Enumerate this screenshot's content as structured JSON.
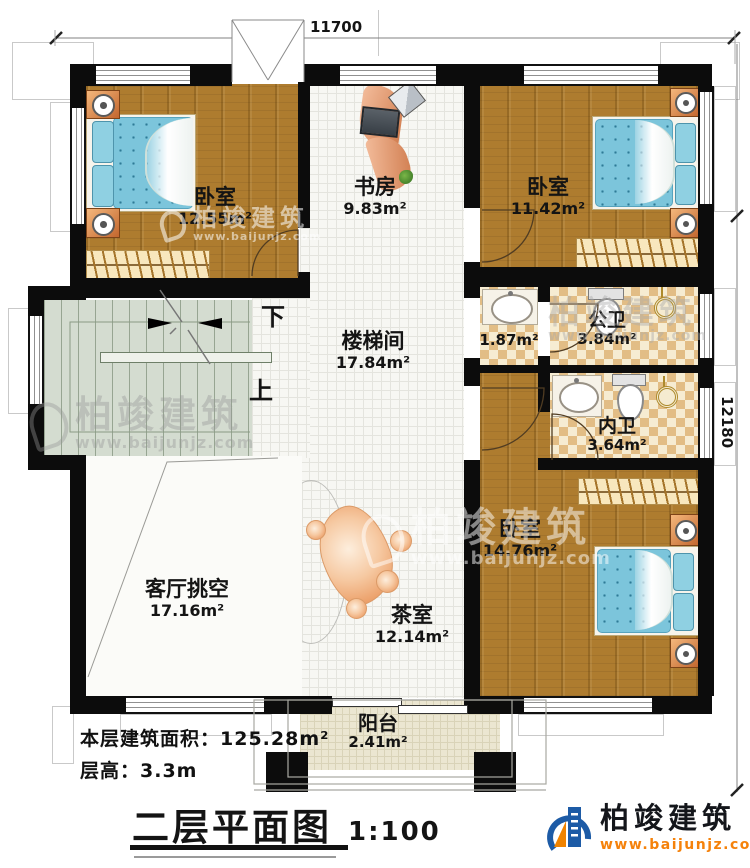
{
  "title": {
    "text": "二层平面图",
    "scale": "1:100"
  },
  "info": {
    "area_label": "本层建筑面积：",
    "area_value": "125.28m²",
    "height_label": "层高：",
    "height_value": "3.3m"
  },
  "dims": {
    "top": "11700",
    "right": "12180"
  },
  "rooms": {
    "bedroom_tl": {
      "name": "卧室",
      "area": "12.55m²"
    },
    "study": {
      "name": "书房",
      "area": "9.83m²"
    },
    "bedroom_tr": {
      "name": "卧室",
      "area": "11.42m²"
    },
    "stair_hall": {
      "name": "楼梯间",
      "area": "17.84m²"
    },
    "vanity": {
      "area": "1.87m²"
    },
    "public_bath": {
      "name": "公卫",
      "area": "3.84m²"
    },
    "private_bath": {
      "name": "内卫",
      "area": "3.64m²"
    },
    "bedroom_br": {
      "name": "卧室",
      "area": "14.76m²"
    },
    "living_void": {
      "name": "客厅挑空",
      "area": "17.16m²"
    },
    "tea_room": {
      "name": "茶室",
      "area": "12.14m²"
    },
    "balcony": {
      "name": "阳台",
      "area": "2.41m²"
    }
  },
  "stairs": {
    "down_label": "下",
    "up_label": "上"
  },
  "brand": {
    "name": "柏竣建筑",
    "url": "www.baijunjz.com",
    "icon": "building-swoosh-icon",
    "accent_orange": "#f5820b",
    "brand_blue": "#1d5ba6"
  },
  "watermark": {
    "name": "柏竣建筑",
    "url": "www.baijunjz.com"
  }
}
